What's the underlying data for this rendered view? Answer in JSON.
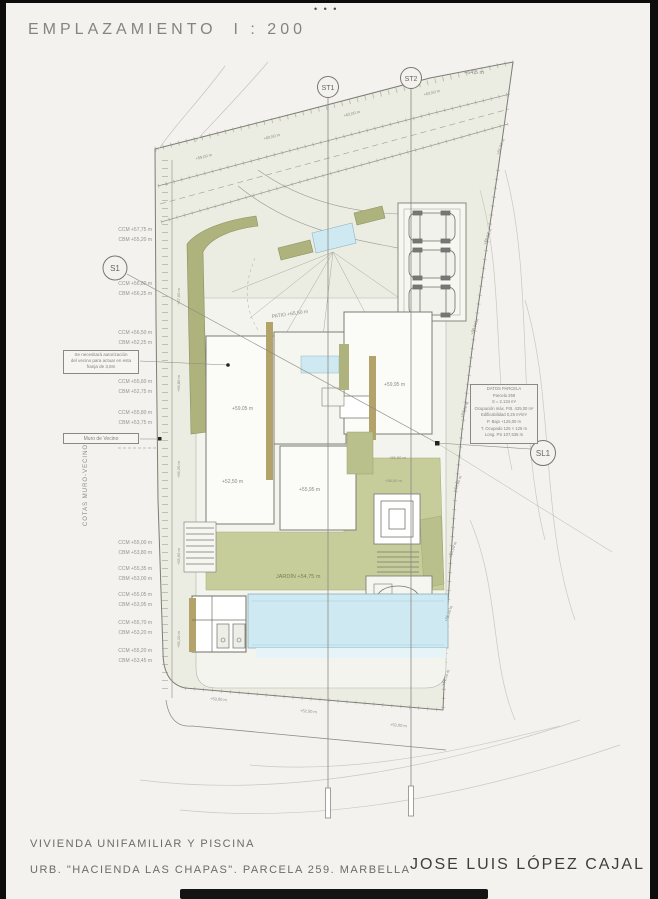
{
  "window": {
    "dots": "• • •"
  },
  "header": {
    "title": "EMPLAZAMIENTO",
    "scale": "I : 200"
  },
  "markers": {
    "st1": "ST1",
    "st2": "ST2",
    "s1": "S1",
    "sl1": "SL1"
  },
  "plan": {
    "labels": [
      "PATIO +65,50 m",
      "+59,05 m",
      "+59,95 m",
      "+55,95 m",
      "+52,50 m",
      "+56,50 m",
      "+58,00 m",
      "JARDÍN +54,75 m",
      "+64,5 m"
    ],
    "ticks": [
      "+63,50 m",
      "+62,00 m",
      "+60,50 m",
      "+59,00 m",
      "+61,00 m",
      "+59,50 m",
      "+58,00 m",
      "+57,00 m",
      "+56,00 m",
      "+55,50 m",
      "+55,00 m",
      "+54,50 m",
      "+57,50 m",
      "+56,80 m",
      "+56,20 m",
      "+55,60 m",
      "+55,10 m",
      "+53,00 m",
      "+52,50 m",
      "+52,00 m"
    ]
  },
  "side": {
    "vertical_title": "COTAS MURO-VECINO",
    "pairs": [
      {
        "a": "CCM +57,75 m",
        "b": "CBM +55,20 m"
      },
      {
        "a": "CCM +56,80 m",
        "b": "CBM +56,25 m"
      },
      {
        "a": "CCM +56,50 m",
        "b": "CBM +52,25 m"
      },
      {
        "a": "CCM +55,60 m",
        "b": "CBM +52,75 m"
      },
      {
        "a": "CCM +55,80 m",
        "b": "CBM +53,75 m"
      },
      {
        "a": "CCM +55,00 m",
        "b": "CBM +53,80 m"
      },
      {
        "a": "CCM +55,35 m",
        "b": "CBM +53,00 m"
      },
      {
        "a": "CCM +55,05 m",
        "b": "CBM +53,95 m"
      },
      {
        "a": "CCM +55,70 m",
        "b": "CBM +53,20 m"
      },
      {
        "a": "CCM +55,20 m",
        "b": "CBM +53,45 m"
      }
    ]
  },
  "notes": {
    "authorization_box": [
      "Se necesitará autorización",
      "del vecino para actuar en esta",
      "franja de 3,8m"
    ],
    "muro_box": "Muro de Vecino",
    "parcel_box": [
      "DATOS PARCELA",
      "Parcela 259",
      "S = 2.134 m²",
      "Ocupación máx. P.B. 425,00 m²",
      "Edificabilidad 0,25 m²/m²",
      "P. Bajo +125,00 m",
      "T. Ocupado 125 × 125 m",
      "Long. PS 107,535 m"
    ]
  },
  "footer": {
    "project": "VIVIENDA UNIFAMILIAR Y PISCINA",
    "location": "URB. \"HACIENDA LAS CHAPAS\". PARCELA 259. MARBELLA",
    "architect": "JOSE LUIS LÓPEZ CAJAL"
  },
  "colors": {
    "paper": "#f3f2ee",
    "terrain": "#ebece2",
    "lawn": "#c6cd9b",
    "planting": "#aeb37d",
    "pool": "#cfe9f2",
    "wall_tan": "#b3a269",
    "line": "#8e8e88"
  }
}
